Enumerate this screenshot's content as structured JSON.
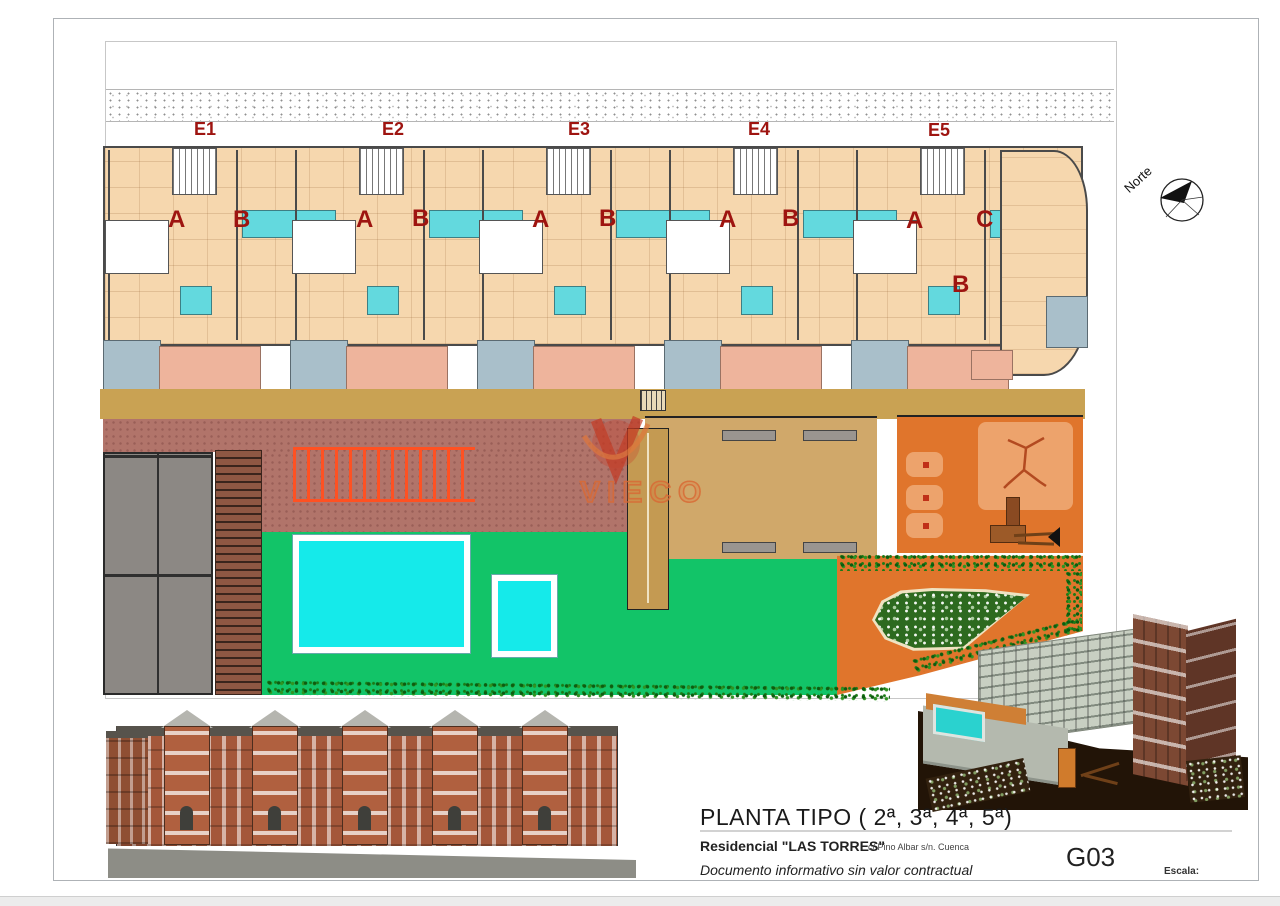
{
  "palette": {
    "label": "#9e1410",
    "floor": "#f6d7ae",
    "wall": "#4a4a4a",
    "bath": "#63d9de",
    "kitchen": "#a9bfca",
    "terrace": "#eeb49c",
    "walk": "#c9a253",
    "paved": "#b1746a",
    "pergola": "#ff5122",
    "lawn": "#12c468",
    "pool": "#15eaea",
    "deck": "#8e5743",
    "block": "#8c8884",
    "plaza": "#d0a86a",
    "play": "#e0752c",
    "panel": "#eda36c",
    "brick": "#a4573a",
    "brickL": "#b0603f"
  },
  "drawing": {
    "sections": [
      {
        "label": "E1"
      },
      {
        "label": "E2"
      },
      {
        "label": "E3"
      },
      {
        "label": "E4"
      },
      {
        "label": "E5"
      }
    ],
    "apartments": [
      {
        "text": "A"
      },
      {
        "text": "B"
      },
      {
        "text": "A"
      },
      {
        "text": "B"
      },
      {
        "text": "A"
      },
      {
        "text": "B"
      },
      {
        "text": "A"
      },
      {
        "text": "B"
      },
      {
        "text": "A"
      },
      {
        "text": "C"
      },
      {
        "text": "B"
      }
    ],
    "compass_label": "Norte"
  },
  "watermark": {
    "text": "VIECO"
  },
  "title_block": {
    "title": "PLANTA TIPO ( 2ª, 3ª, 4ª, 5ª)",
    "project": "Residencial \"LAS TORRES\"",
    "address": "c/ Pino Albar s/n. Cuenca",
    "disclaimer": "Documento informativo sin valor contractual",
    "sheet": "G03",
    "scale_label": "Escala:"
  }
}
